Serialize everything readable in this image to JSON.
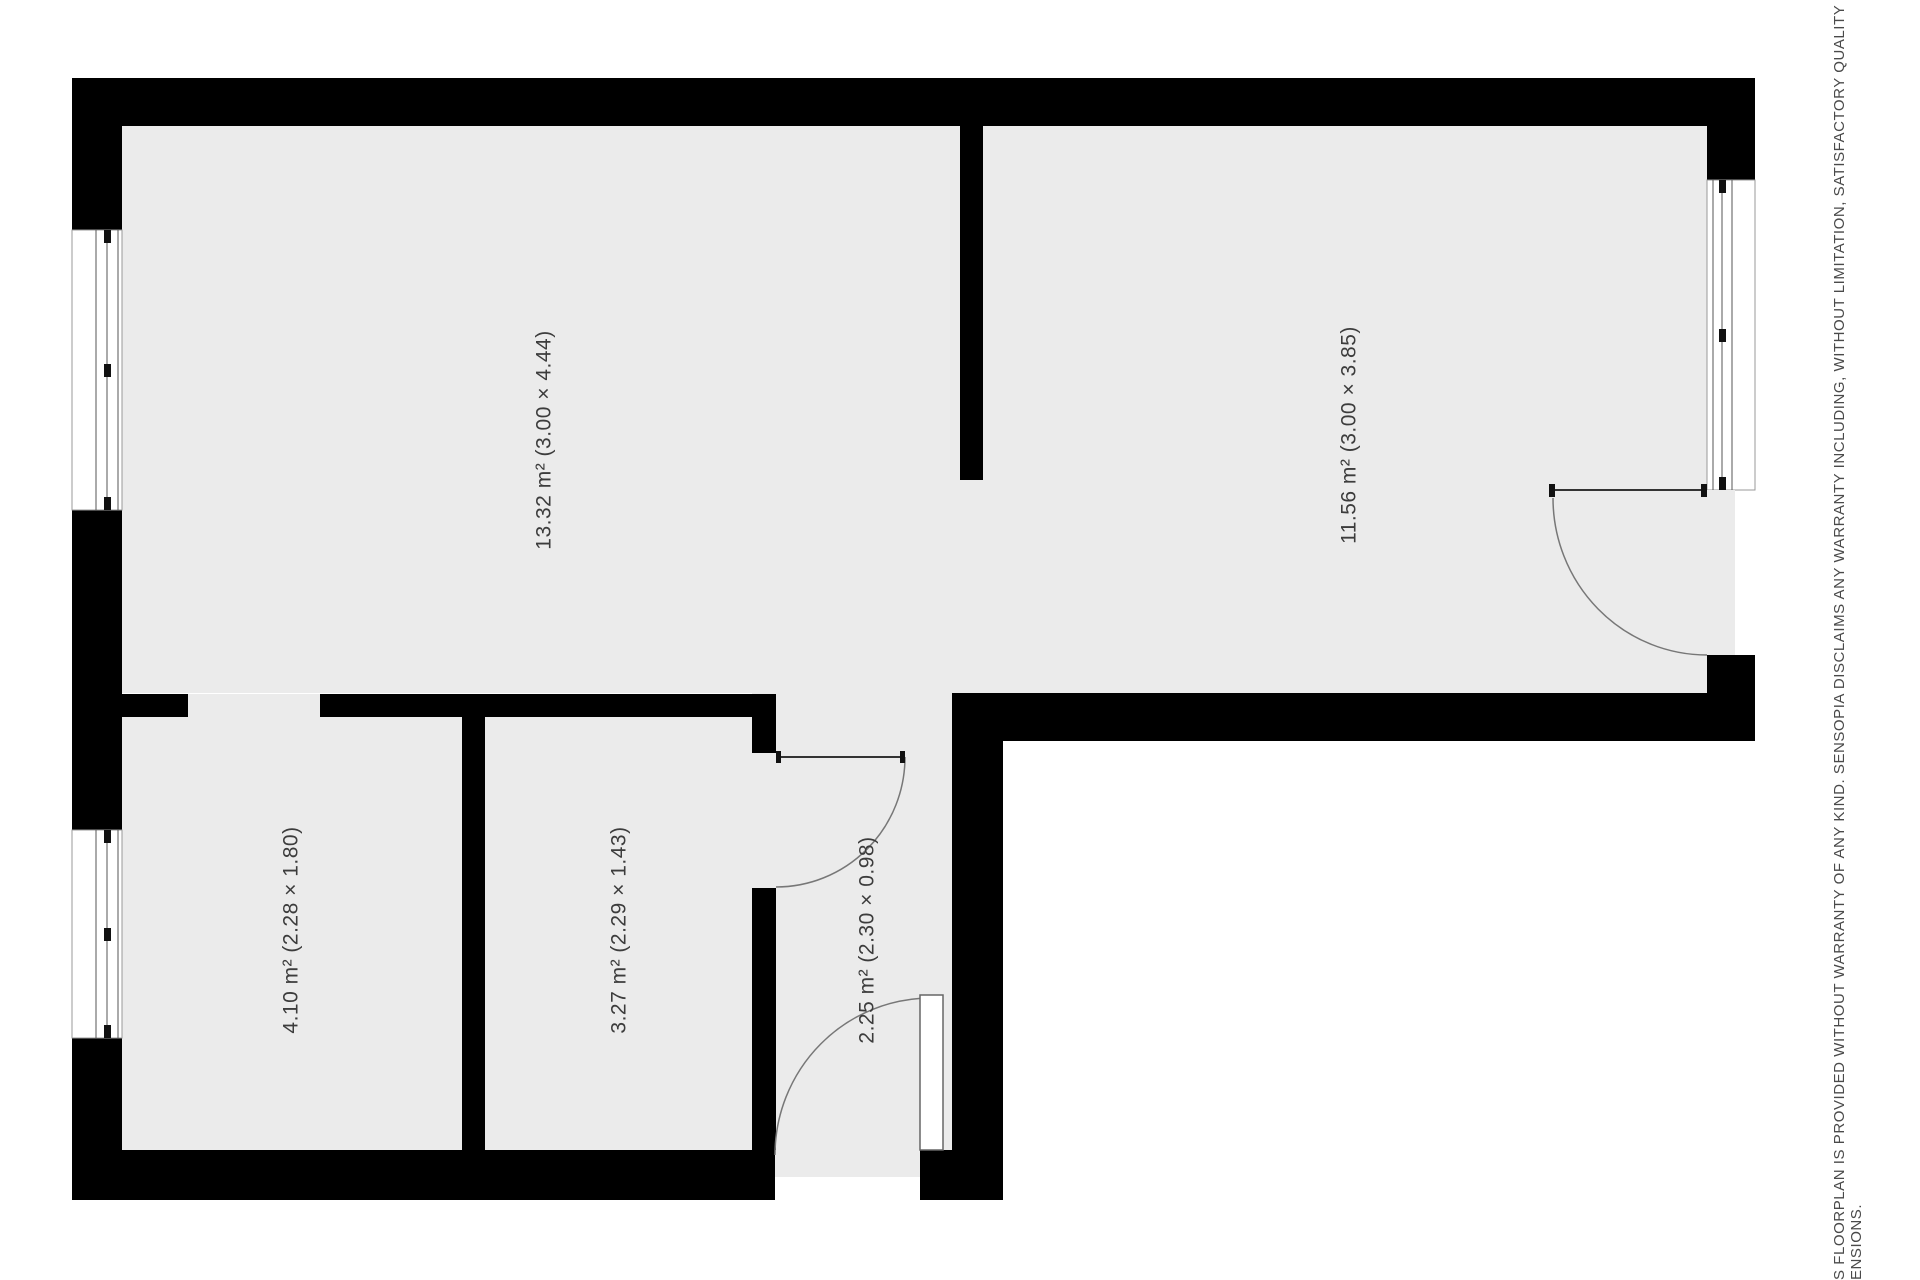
{
  "colors": {
    "floor": "#ebebeb",
    "wall": "#000000",
    "swing_line": "#777777",
    "leaf_line": "#333333",
    "window_edge": "#999999",
    "window_line": "#555555",
    "tick": "#111111",
    "label_text": "#3c3c3c",
    "disclaimer_text": "#4a4a4a",
    "background": "#ffffff"
  },
  "rooms": [
    {
      "area_m2": "13.32",
      "dimensions": "3.00 × 4.44",
      "label": "13.32 m² (3.00 × 4.44)",
      "cx": 545,
      "cy": 440
    },
    {
      "area_m2": "11.56",
      "dimensions": "3.00 × 3.85",
      "label": "11.56 m² (3.00 × 3.85)",
      "cx": 1350,
      "cy": 435
    },
    {
      "area_m2": "4.10",
      "dimensions": "2.28 × 1.80",
      "label": "4.10 m² (2.28 × 1.80)",
      "cx": 292,
      "cy": 930
    },
    {
      "area_m2": "3.27",
      "dimensions": "2.29 × 1.43",
      "label": "3.27 m² (2.29 × 1.43)",
      "cx": 620,
      "cy": 930
    },
    {
      "area_m2": "2.25",
      "dimensions": "2.30 × 0.98",
      "label": "2.25 m² (2.30 × 0.98)",
      "cx": 868,
      "cy": 940
    }
  ],
  "disclaimer": {
    "line1": "S FLOORPLAN IS PROVIDED WITHOUT WARRANTY OF ANY KIND. SENSOPIA DISCLAIMS ANY WARRANTY INCLUDING, WITHOUT LIMITATION, SATISFACTORY QUALITY OR ACCURACY OF",
    "line2": "ENSIONS."
  },
  "plan": {
    "canvas": {
      "w": 1920,
      "h": 1280
    },
    "floors": [
      [
        122,
        126,
        1585,
        567
      ],
      [
        122,
        694,
        653,
        456
      ],
      [
        752,
        693,
        208,
        457
      ]
    ],
    "walls": [
      [
        72,
        78,
        1683,
        48
      ],
      [
        72,
        126,
        50,
        104
      ],
      [
        72,
        510,
        50,
        320
      ],
      [
        72,
        1038,
        50,
        162
      ],
      [
        72,
        1150,
        703,
        50
      ],
      [
        920,
        1150,
        83,
        50
      ],
      [
        952,
        693,
        51,
        457
      ],
      [
        982,
        693,
        773,
        48
      ],
      [
        1707,
        126,
        48,
        54
      ],
      [
        1707,
        655,
        48,
        86
      ],
      [
        960,
        126,
        23,
        354
      ],
      [
        122,
        694,
        66,
        23
      ],
      [
        320,
        694,
        456,
        23
      ],
      [
        462,
        717,
        23,
        433
      ],
      [
        752,
        694,
        24,
        59
      ],
      [
        752,
        888,
        24,
        262
      ]
    ],
    "windows": [
      {
        "rect": [
          72,
          230,
          50,
          280
        ],
        "lines_x": [
          96,
          107,
          118
        ],
        "tick_x": 104,
        "ticks_y": [
          230,
          364,
          497
        ]
      },
      {
        "rect": [
          72,
          830,
          50,
          208
        ],
        "lines_x": [
          96,
          107,
          118
        ],
        "tick_x": 104,
        "ticks_y": [
          830,
          928,
          1025
        ]
      },
      {
        "rect": [
          1707,
          180,
          48,
          310
        ],
        "lines_x": [
          1713,
          1722,
          1732
        ],
        "tick_x": 1719,
        "ticks_y": [
          180,
          329,
          477
        ]
      }
    ],
    "doors": [
      {
        "id": "door-right-room",
        "threshold": [
          1707,
          490,
          28,
          165
        ],
        "leaf_line": [
          1553,
          490,
          1707,
          490
        ],
        "ticks": [
          [
            1549,
            484,
            6,
            13
          ],
          [
            1701,
            484,
            6,
            13
          ]
        ],
        "arc": "M 1553 498 A 154 157 0 0 0 1707 655"
      },
      {
        "id": "door-inner-room",
        "leaf_line": [
          776,
          757,
          905,
          757
        ],
        "ticks": [
          [
            776,
            751,
            5,
            12
          ],
          [
            900,
            751,
            5,
            12
          ]
        ],
        "arc": "M 905 757 A 129 130 0 0 1 776 887"
      },
      {
        "id": "door-entry",
        "threshold": [
          775,
          1150,
          145,
          27
        ],
        "leaf_rect": [
          920,
          995,
          23,
          155
        ],
        "arc": "M 931 998 A 156 157 0 0 0 775 1155"
      }
    ]
  }
}
